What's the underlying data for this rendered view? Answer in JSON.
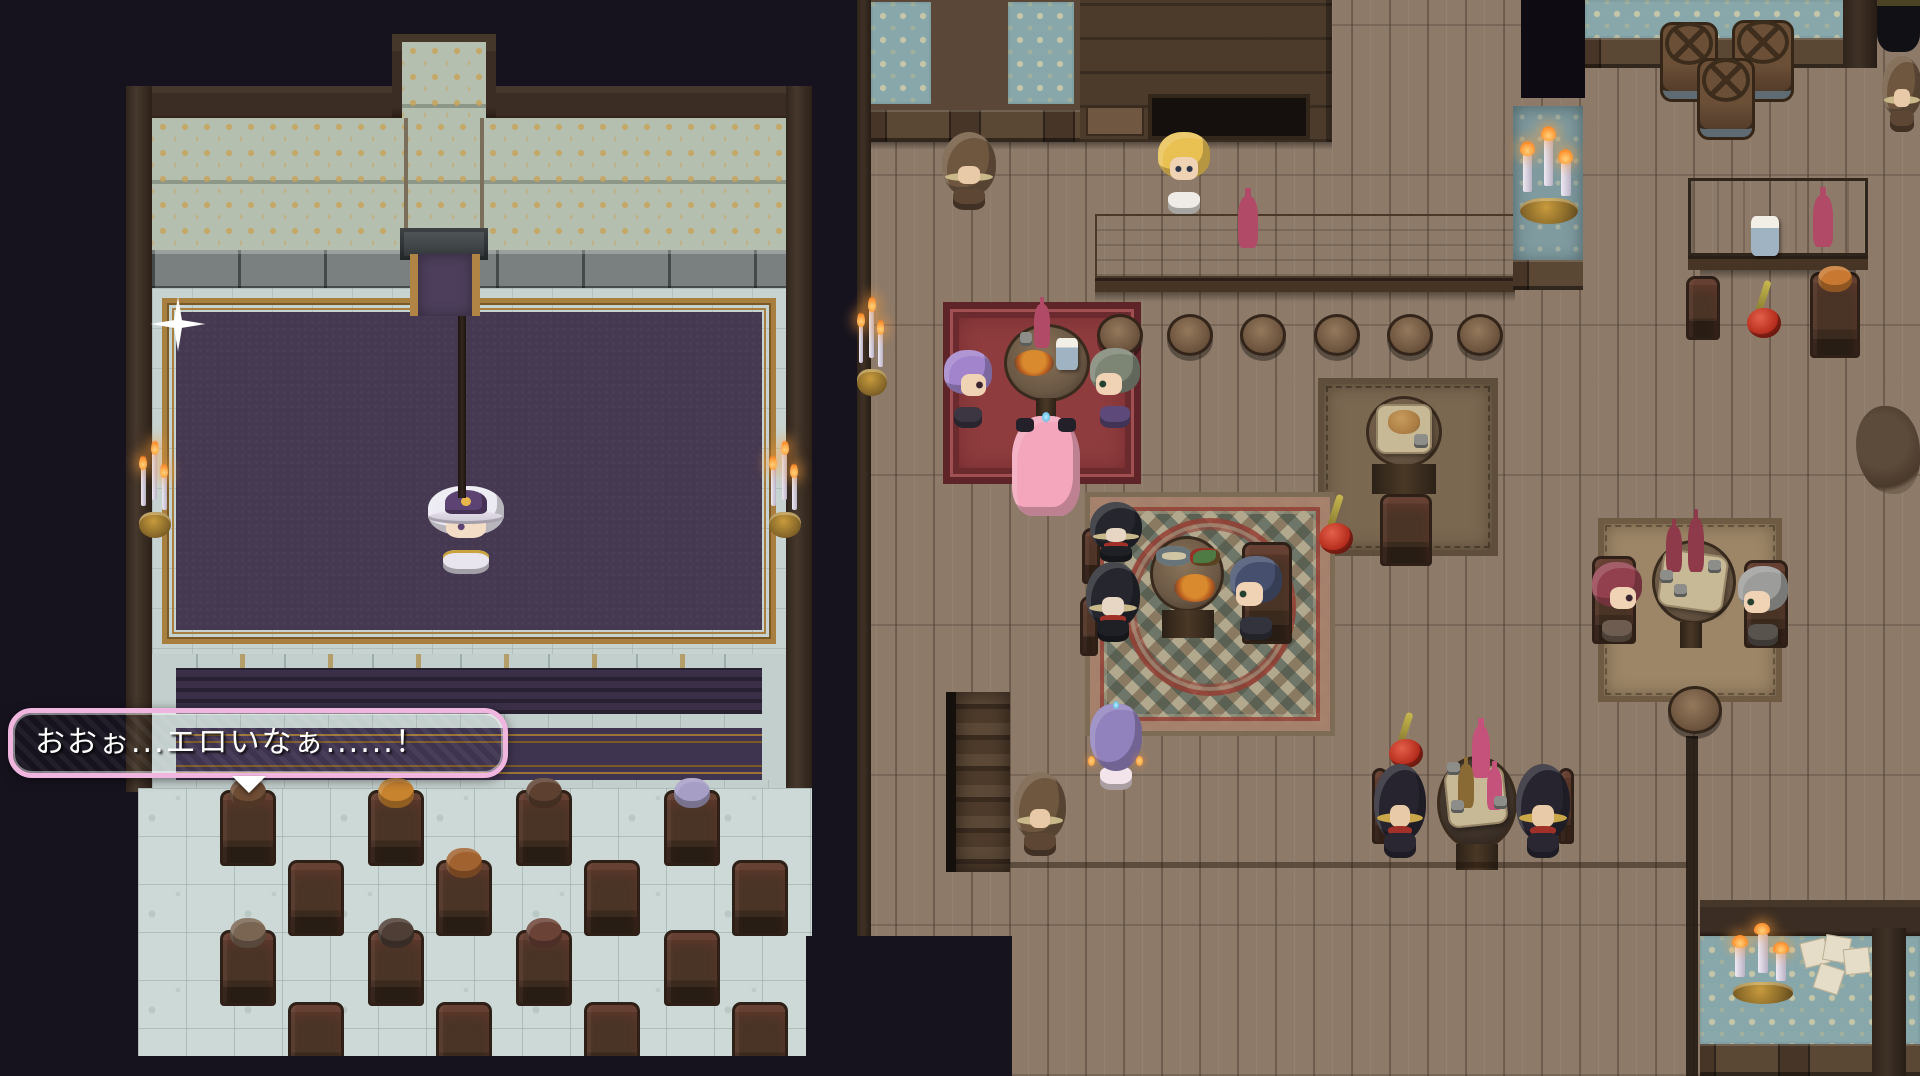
{
  "scene": {
    "title": "RPG Maker tavern and theater stage scene",
    "dialogue": {
      "text": "おおぉ...エロいなぁ......！"
    }
  },
  "colors": {
    "dialogue_border": "#f0b6df",
    "void": "#16131f",
    "tavern_floor": "#8d7a69",
    "theater_tile_floor": "#cdd9d7",
    "stage_purple": "#453951",
    "gold_frame": "#a97f3f",
    "wallpaper_teal": "#87a7ab",
    "rug_red": "#8e3c3e"
  },
  "npcs": [
    {
      "id": "witch-performer",
      "variant": "witch",
      "x": 428,
      "y": 486,
      "w": 76,
      "h": 88,
      "hair": "#eceaf2",
      "body": "#e9e5ee",
      "extra": "#5c4372"
    },
    {
      "id": "hooded-monk-top",
      "variant": "hooded-brown",
      "x": 942,
      "y": 132,
      "w": 54,
      "h": 78,
      "hair": "#6f573f",
      "body": "#5d4734"
    },
    {
      "id": "bartender",
      "variant": "front",
      "x": 1158,
      "y": 132,
      "w": 52,
      "h": 82,
      "hair": "#e9c052",
      "body": "#efece8"
    },
    {
      "id": "purple-twintail-girl",
      "variant": "side-right",
      "x": 944,
      "y": 350,
      "w": 48,
      "h": 78,
      "hair": "#a184cc",
      "body": "#3c3542"
    },
    {
      "id": "green-haired-noble",
      "variant": "side-left",
      "x": 1090,
      "y": 348,
      "w": 50,
      "h": 80,
      "hair": "#7d8574",
      "body": "#5e4a7a"
    },
    {
      "id": "pink-princess",
      "variant": "away-long",
      "x": 1012,
      "y": 416,
      "w": 68,
      "h": 100,
      "hair": "#f4a6bc",
      "body": "#f8cdd9"
    },
    {
      "id": "dark-hood-1",
      "variant": "hooded-dark",
      "x": 1090,
      "y": 502,
      "w": 52,
      "h": 60,
      "hair": "#25262e",
      "body": "#1f2026"
    },
    {
      "id": "dark-hood-2",
      "variant": "hooded-dark",
      "x": 1086,
      "y": 562,
      "w": 54,
      "h": 80,
      "hair": "#25262e",
      "body": "#1f2026"
    },
    {
      "id": "blue-haired-patron",
      "variant": "side-left",
      "x": 1230,
      "y": 556,
      "w": 52,
      "h": 84,
      "hair": "#46506e",
      "body": "#33333d"
    },
    {
      "id": "red-haired-patron",
      "variant": "side-right",
      "x": 1592,
      "y": 562,
      "w": 50,
      "h": 80,
      "hair": "#93404e",
      "body": "#6e5c50"
    },
    {
      "id": "gray-haired-patron",
      "variant": "side-left",
      "x": 1738,
      "y": 566,
      "w": 50,
      "h": 80,
      "hair": "#9c9c9a",
      "body": "#58534c"
    },
    {
      "id": "gold-hood-left",
      "variant": "hooded-gold",
      "x": 1374,
      "y": 764,
      "w": 52,
      "h": 94,
      "hair": "#27242f",
      "body": "#2a2733"
    },
    {
      "id": "gold-hood-right",
      "variant": "hooded-gold",
      "x": 1516,
      "y": 764,
      "w": 54,
      "h": 94,
      "hair": "#27242f",
      "body": "#2a2733"
    },
    {
      "id": "purple-girl-below",
      "variant": "away",
      "x": 1090,
      "y": 704,
      "w": 52,
      "h": 84,
      "hair": "#9181bd",
      "body": "#f2e4ea"
    },
    {
      "id": "hooded-monk-stairs",
      "variant": "hooded-brown",
      "x": 1014,
      "y": 772,
      "w": 52,
      "h": 84,
      "hair": "#6f573f",
      "body": "#5d4734"
    },
    {
      "id": "hooded-monk-edge",
      "variant": "hooded-brown",
      "x": 1882,
      "y": 56,
      "w": 40,
      "h": 76,
      "hair": "#6f573f",
      "body": "#5d4734"
    }
  ],
  "audience_rows": [
    {
      "y": 790,
      "xs": [
        220,
        368,
        516,
        664
      ],
      "heads": [
        "#6f4c34",
        "#c8832e",
        "#5d4030",
        "#a79ec6"
      ]
    },
    {
      "y": 860,
      "xs": [
        288,
        436,
        584,
        732
      ],
      "heads": [
        null,
        "#a2622f",
        null,
        null
      ]
    },
    {
      "y": 930,
      "xs": [
        220,
        368,
        516,
        664
      ],
      "heads": [
        "#7a6553",
        "#4e3e36",
        "#6b4236",
        null
      ]
    },
    {
      "y": 1002,
      "xs": [
        288,
        436,
        584,
        732
      ],
      "heads": [
        null,
        null,
        null,
        null
      ]
    }
  ],
  "tavern_chairs": [
    {
      "x": 1686,
      "y": 276,
      "w": 34,
      "h": 64,
      "head": null
    },
    {
      "x": 1810,
      "y": 272,
      "w": 50,
      "h": 86,
      "head": "#c87830"
    },
    {
      "x": 1592,
      "y": 556,
      "w": 44,
      "h": 88,
      "head": null
    },
    {
      "x": 1744,
      "y": 560,
      "w": 44,
      "h": 88,
      "head": null
    },
    {
      "x": 1242,
      "y": 542,
      "w": 50,
      "h": 102,
      "head": null
    },
    {
      "x": 1380,
      "y": 494,
      "w": 52,
      "h": 72,
      "head": null
    },
    {
      "x": 1372,
      "y": 768,
      "w": 16,
      "h": 76,
      "head": null
    },
    {
      "x": 1558,
      "y": 768,
      "w": 16,
      "h": 76,
      "head": null
    },
    {
      "x": 1082,
      "y": 528,
      "w": 18,
      "h": 56,
      "head": null
    },
    {
      "x": 1080,
      "y": 596,
      "w": 18,
      "h": 60,
      "head": null
    }
  ],
  "stools": [
    {
      "x": 1097,
      "y": 314,
      "w": 46,
      "h": 42
    },
    {
      "x": 1167,
      "y": 314,
      "w": 46,
      "h": 42
    },
    {
      "x": 1240,
      "y": 314,
      "w": 46,
      "h": 42
    },
    {
      "x": 1314,
      "y": 314,
      "w": 46,
      "h": 42
    },
    {
      "x": 1387,
      "y": 314,
      "w": 46,
      "h": 42
    },
    {
      "x": 1457,
      "y": 314,
      "w": 46,
      "h": 42
    },
    {
      "x": 1668,
      "y": 686,
      "w": 54,
      "h": 48
    }
  ],
  "barrels": [
    {
      "x": 1660,
      "y": 22,
      "w": 58,
      "h": 80
    },
    {
      "x": 1732,
      "y": 20,
      "w": 62,
      "h": 82
    },
    {
      "x": 1697,
      "y": 58,
      "w": 58,
      "h": 82
    }
  ],
  "sconces": [
    {
      "id": "stage-left-sconce",
      "x": 138,
      "y": 444,
      "w": 34,
      "h": 94
    },
    {
      "id": "stage-right-sconce",
      "x": 768,
      "y": 444,
      "w": 34,
      "h": 94
    },
    {
      "id": "tavern-wall-sconce",
      "x": 856,
      "y": 300,
      "w": 32,
      "h": 96
    },
    {
      "id": "counter-candelabra",
      "x": 1518,
      "y": 130,
      "w": 62,
      "h": 94
    },
    {
      "id": "lounge-candelabra",
      "x": 1730,
      "y": 926,
      "w": 66,
      "h": 78
    }
  ],
  "apple_stands": [
    {
      "x": 1744,
      "y": 280,
      "w": 42,
      "h": 58
    },
    {
      "x": 1316,
      "y": 494,
      "w": 42,
      "h": 60
    },
    {
      "x": 1386,
      "y": 712,
      "w": 42,
      "h": 56
    }
  ]
}
